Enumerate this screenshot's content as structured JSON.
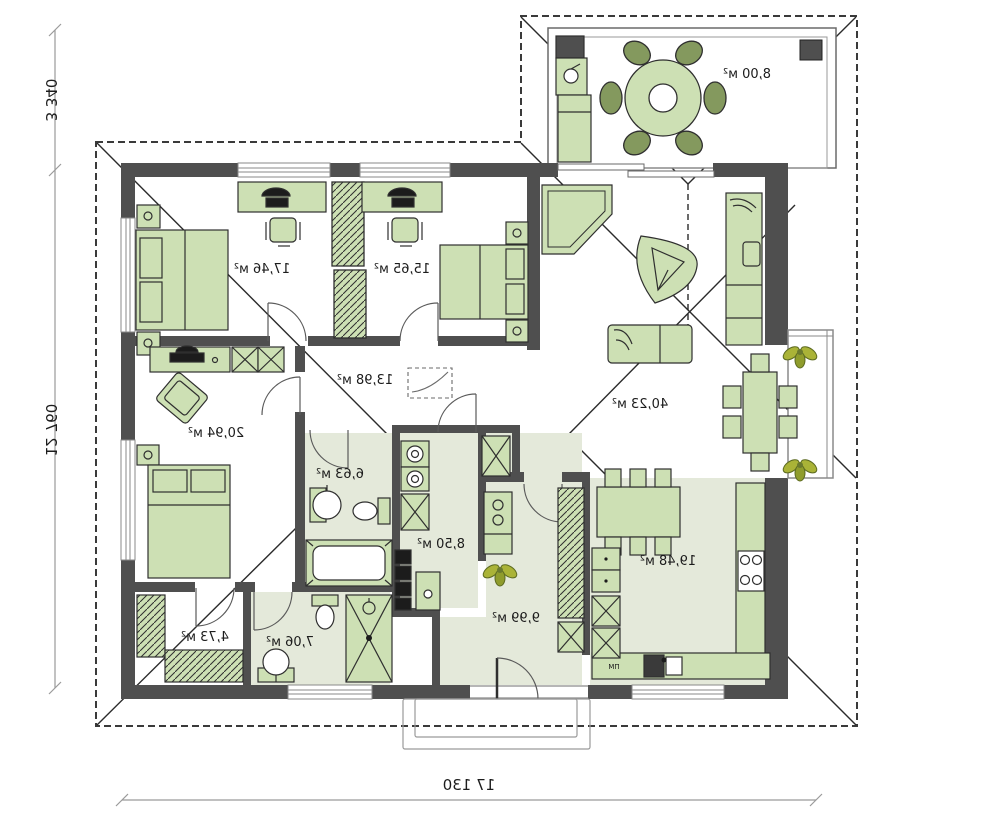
{
  "plan": {
    "type": "house-floor-plan-mirrored",
    "rooms": {
      "bedroom1": "17,46 м²",
      "bedroom2": "15,65 м²",
      "corridor": "13,98 м²",
      "master_bedroom": "20,94 м²",
      "bathroom_1": "6,63 м²",
      "utility": "8,50 м²",
      "hall": "9,99 м²",
      "kitchen": "19,48 м²",
      "living_room": "40,23 м²",
      "wardrobe_room": "4,73 м²",
      "bathroom_2": "7,06 м²",
      "terrace": "8,00 м²"
    },
    "dimensions": {
      "terrace_depth": "3 340",
      "house_depth": "12 760",
      "total_width": "17 130"
    },
    "labels": {
      "dishwasher": "ПМ"
    },
    "colors": {
      "wall": "#4f4f4f",
      "furniture_fill": "#cde0b4",
      "furniture_stroke": "#2f2f2f",
      "floor_tint": "#e4e9da",
      "roof_line": "#2b2b2b",
      "dim_line": "#9a9a9a",
      "plant": "#aab337"
    }
  }
}
